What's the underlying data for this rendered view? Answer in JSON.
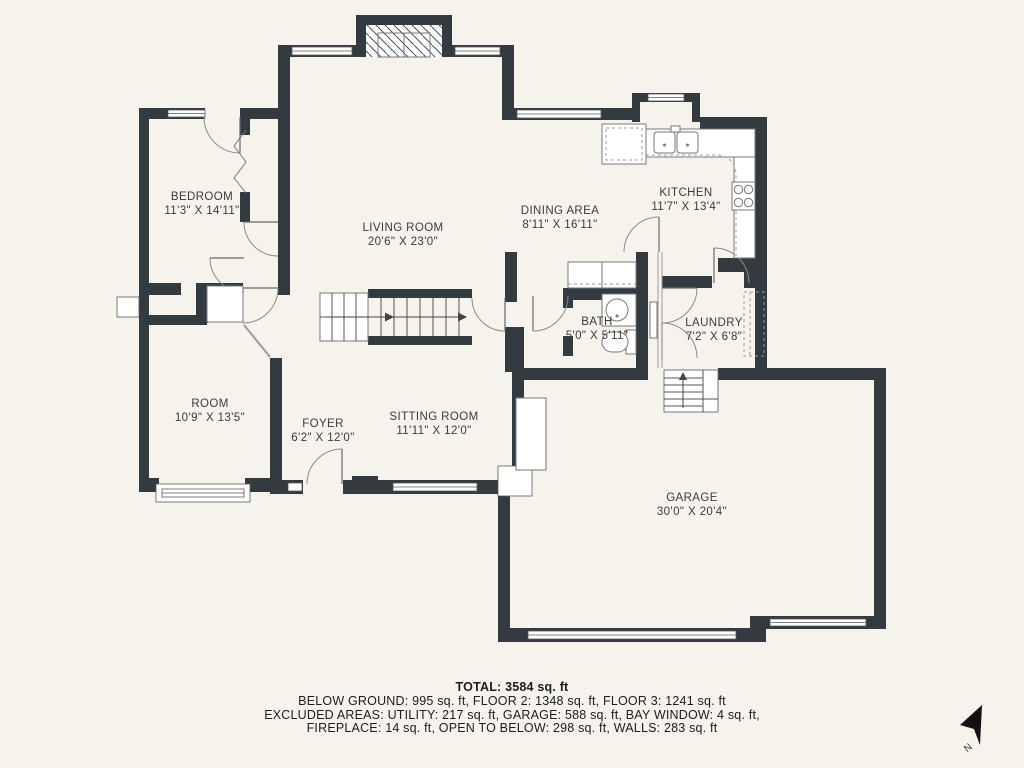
{
  "page": {
    "background": "#f5f3eb",
    "wall_color": "#333a40",
    "line_color": "#555555",
    "text_color": "#3b3b3b"
  },
  "rooms": {
    "bedroom": {
      "name": "BEDROOM",
      "dims": "11'3\" X 14'11\""
    },
    "living": {
      "name": "LIVING ROOM",
      "dims": "20'6\" X 23'0\""
    },
    "dining": {
      "name": "DINING AREA",
      "dims": "8'11\" X 16'11\""
    },
    "kitchen": {
      "name": "KITCHEN",
      "dims": "11'7\" X 13'4\""
    },
    "bath": {
      "name": "BATH",
      "dims": "5'0\" X 5'11\""
    },
    "laundry": {
      "name": "LAUNDRY",
      "dims": "7'2\" X 6'8\""
    },
    "room": {
      "name": "ROOM",
      "dims": "10'9\" X 13'5\""
    },
    "foyer": {
      "name": "FOYER",
      "dims": "6'2\" X 12'0\""
    },
    "sitting": {
      "name": "SITTING ROOM",
      "dims": "11'11\" X 12'0\""
    },
    "garage": {
      "name": "GARAGE",
      "dims": "30'0\" X 20'4\""
    }
  },
  "summary": {
    "total": "TOTAL: 3584 sq. ft",
    "floors": "BELOW GROUND: 995 sq. ft, FLOOR 2: 1348 sq. ft, FLOOR 3: 1241 sq. ft",
    "excluded1": "EXCLUDED AREAS: UTILITY: 217 sq. ft, GARAGE: 588 sq. ft, BAY WINDOW: 4 sq. ft,",
    "excluded2": "FIREPLACE: 14 sq. ft, OPEN TO BELOW: 298 sq. ft, WALLS: 283 sq. ft"
  },
  "compass": {
    "label": "N"
  }
}
